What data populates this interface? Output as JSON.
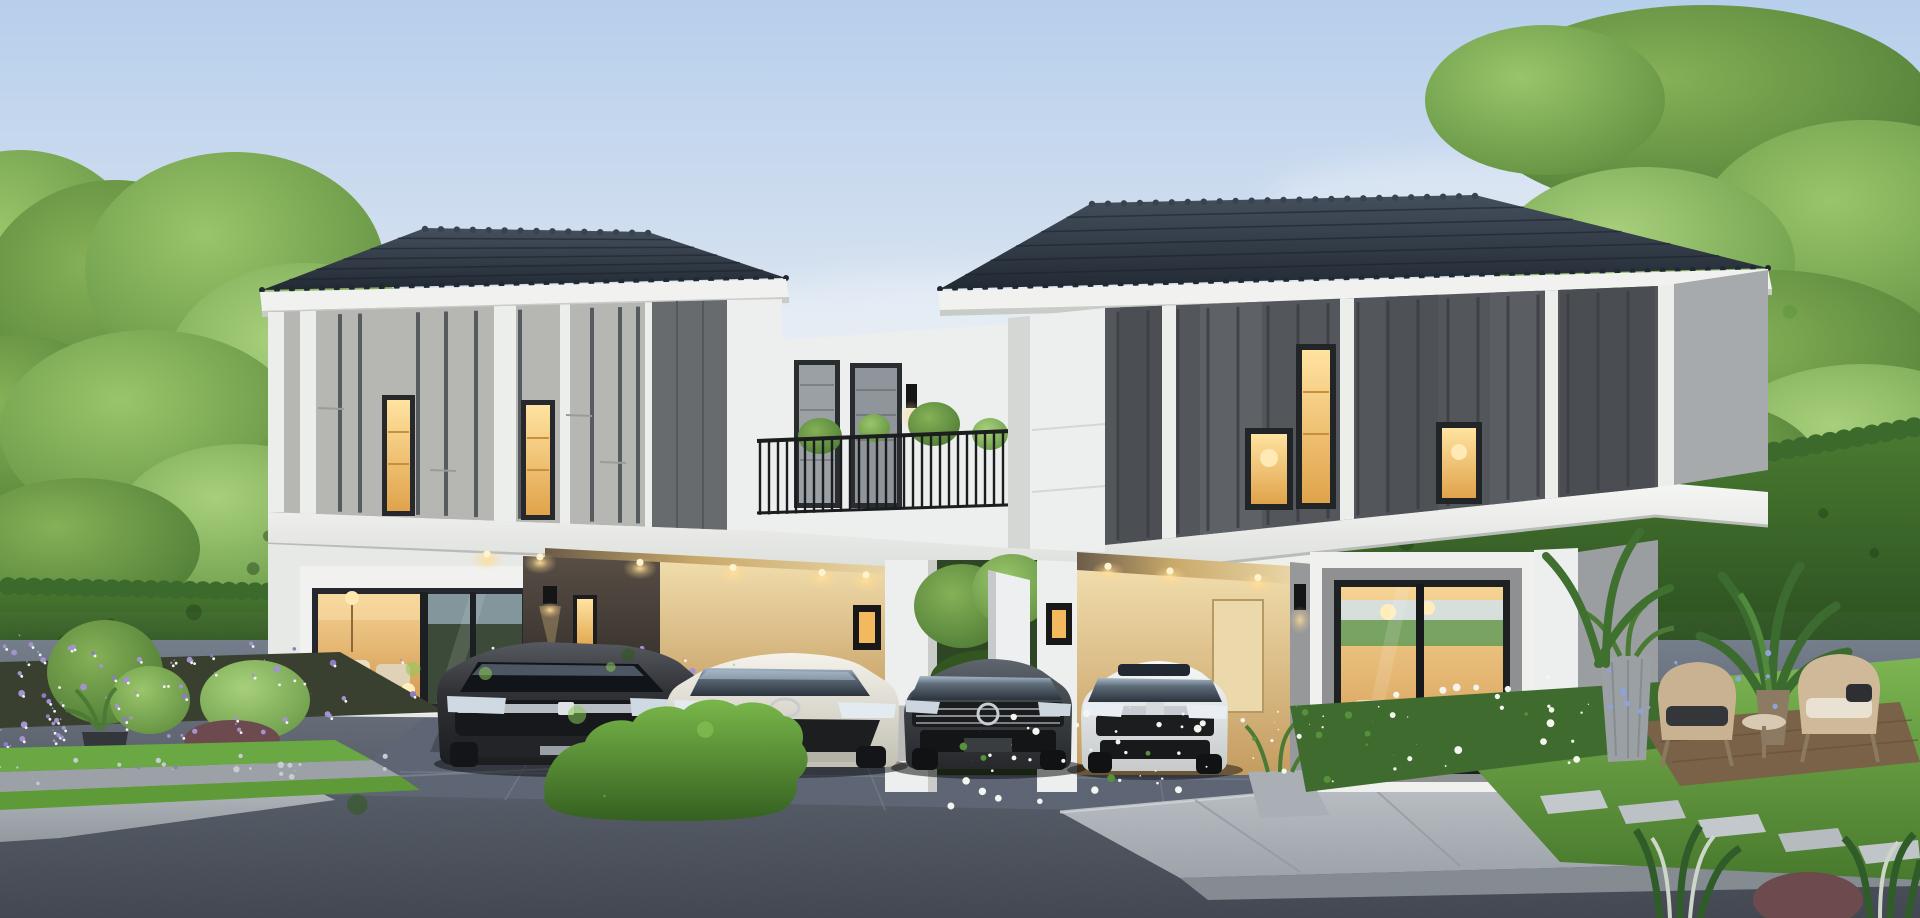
{
  "meta": {
    "type": "photorealistic architectural rendering",
    "scene": "twin modern two-storey detached houses at dusk with carports, four parked cars, landscaped gardens and an asphalt street in the foreground",
    "time_of_day": "dusk",
    "visible_text": "none"
  },
  "palette": {
    "sky_top": "#b7cfec",
    "sky_horizon": "#f6f3ec",
    "cloud": "#ffffff",
    "roof": "#2a333f",
    "fascia": "#f1f2ef",
    "wall_white": "#edefee",
    "panel_light": "#b6b7b3",
    "panel_dark_left": "#686b6e",
    "panel_dark_right": "#53565b",
    "pilaster": "#eceeec",
    "batten_dark": "#3f454c",
    "slab": "#eff0ee",
    "carport_warm": "#e4cf9e",
    "carport_dark": "#453e38",
    "window_glow": "#f5c873",
    "window_frame": "#26282b",
    "railing": "#1b1d1f",
    "tree_green": "#69a044",
    "hedge": "#3c6a2c",
    "lawn": "#5f9a38",
    "flower_white": "#f3f6ee",
    "flower_purple": "#a493d1",
    "flower_blue": "#8fa3d8",
    "road": "#58616d",
    "driveway": "#59606d",
    "sidewalk": "#b7bdc2",
    "concrete": "#b4bac0",
    "glow": "#ffd98f",
    "car_suv_dark": "#2b2d30",
    "car_sedan_champagne": "#e6e3da",
    "car_sedan_graphite": "#3e4247",
    "car_sedan_white": "#e9eaea",
    "chair_wicker": "#c9b292",
    "planter_grey": "#9aa0a3",
    "wood_deck": "#8a6e4f",
    "trunk": "#4e3e2c"
  },
  "scene": {
    "sky": {
      "label": "dusk sky with soft clouds",
      "clouds": 3
    },
    "background": {
      "left_trees": "tall green trees",
      "left_neighbor_houses": "white two-storey homes behind hedge",
      "right_tree": "large overhanging tree",
      "right_neighbor_house": "white house with grey roof",
      "hedge_left": "clipped green hedge wall",
      "hedge_right": "tall clipped hedge with white fence above"
    },
    "left_house": {
      "label": "left twin house",
      "storeys": 2,
      "roof": "dark grey hipped tile roof",
      "facade": "light grey vertical panels with dark battens",
      "upper_windows_lit": 2,
      "feature_panel": "dark grey panel section",
      "living_room": "wide warm-lit sliding glass door",
      "carport": {
        "downlights": 6,
        "wall_sconce": true,
        "lit_wall_plaque": true,
        "slot_window_lit": true
      },
      "cars": [
        {
          "label": "dark grey SUV"
        },
        {
          "label": "champagne white sedan"
        }
      ]
    },
    "middle": {
      "terrace": "shared balcony with black metal railing and potted plants",
      "passage": "open white gate with greenery behind"
    },
    "right_house": {
      "label": "right twin house",
      "storeys": 2,
      "roof": "dark grey hipped tile roof",
      "facade": "charcoal vertical panels with white pilasters",
      "upper_windows_lit": 3,
      "living_room": "large sliding glass door with warm lit lounge",
      "carport": {
        "downlights": 3,
        "lit_wall_plaque": true,
        "wall_sconce": true
      },
      "cars": [
        {
          "label": "graphite grey sedan"
        },
        {
          "label": "white sedan"
        }
      ]
    },
    "garden_left": {
      "flowers": "purple and white blossom bed",
      "planters": 2,
      "shrubs": "tall green and burgundy shrubs",
      "grass_gravel_strips": true
    },
    "garden_right": {
      "flower_bed": "white flowers",
      "lawn": true,
      "stepping_stones": true,
      "furniture": "two wicker armchairs with side table",
      "planter": "tall grey pot with tropical plant",
      "deck": "wooden deck pad"
    },
    "foreground": {
      "road": "asphalt street",
      "driveways": 2,
      "center_hedge": "clipped bright green bush",
      "sidewalk": "paved walkway on the right"
    }
  }
}
